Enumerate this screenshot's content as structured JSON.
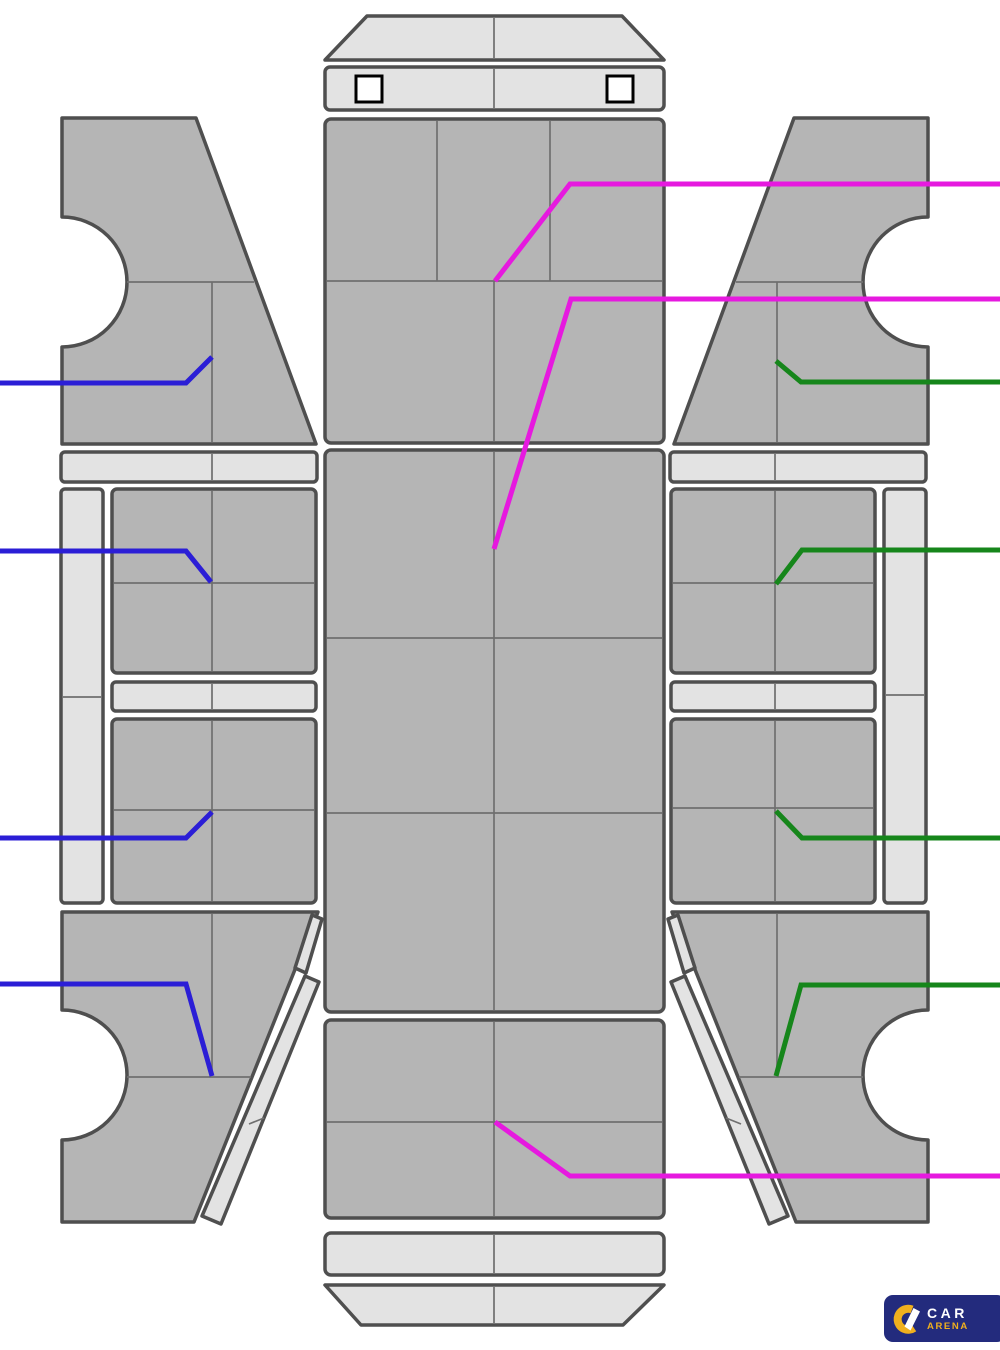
{
  "colors": {
    "panel": "#b5b5b5",
    "light": "#e3e3e3",
    "outline": "#4f4f4f",
    "inner_line": "#6f6f6f",
    "square_outline": "#000000",
    "blue": "#2b1ed6",
    "magenta": "#e619df",
    "green": "#16861b",
    "logo_bg": "#232b7d",
    "logo_yellow": "#f0b01e"
  },
  "logo": {
    "line1": "CAR",
    "line2": "ARENA"
  },
  "callouts": [
    {
      "name": "blue-front-fender-left",
      "color": "blue",
      "points": "0,383 186,383 212,357"
    },
    {
      "name": "blue-front-door-left",
      "color": "blue",
      "points": "0,551 186,551 211,582"
    },
    {
      "name": "blue-rear-door-left",
      "color": "blue",
      "points": "0,838 186,838 212,812"
    },
    {
      "name": "blue-quarter-left",
      "color": "blue",
      "points": "0,984 186,984 212,1076"
    },
    {
      "name": "green-front-fender-right",
      "color": "green",
      "points": "1000,382 801,382 776,361"
    },
    {
      "name": "green-front-door-right",
      "color": "green",
      "points": "1000,550 802,550 776,584"
    },
    {
      "name": "green-rear-door-right",
      "color": "green",
      "points": "1000,838 802,838 776,811"
    },
    {
      "name": "green-quarter-right",
      "color": "green",
      "points": "1000,985 801,985 776,1076"
    },
    {
      "name": "magenta-cowl",
      "color": "magenta",
      "points": "1000,184 570,184 495,281"
    },
    {
      "name": "magenta-roof",
      "color": "magenta",
      "points": "1000,299 571,299 494,549"
    },
    {
      "name": "magenta-trunk",
      "color": "magenta",
      "points": "1000,1176 570,1176 495,1122"
    }
  ]
}
